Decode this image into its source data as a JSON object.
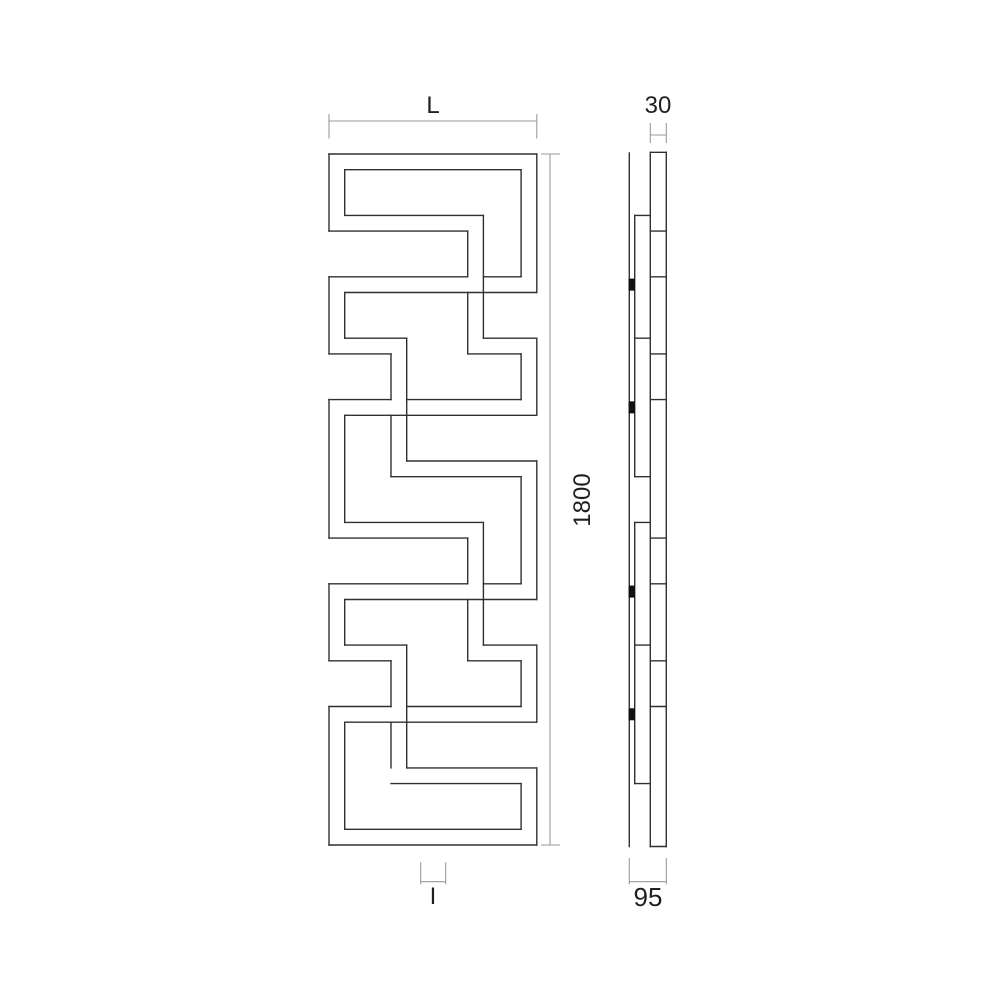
{
  "figure": {
    "background": "#ffffff",
    "line_color": "#303030",
    "dim_line_color": "#9a9a9a",
    "label_color": "#1f1f1f"
  },
  "labels": {
    "width": "L",
    "tube_depth": "30",
    "height": "1800",
    "total_depth": "95",
    "interaxis": "I"
  },
  "front_view": {
    "lines": [
      [
        329,
        154,
        536.8,
        154
      ],
      [
        344.7,
        169.7,
        521.1,
        169.7
      ],
      [
        344.7,
        215.4,
        483.4,
        215.4
      ],
      [
        329,
        231.1,
        467.7,
        231.1
      ],
      [
        329,
        276.8,
        467.7,
        276.8
      ],
      [
        483.4,
        276.8,
        521.1,
        276.8
      ],
      [
        344.7,
        292.5,
        536.8,
        292.5
      ],
      [
        344.7,
        338.2,
        406.7,
        338.2
      ],
      [
        329,
        353.9,
        391,
        353.9
      ],
      [
        483.4,
        338.2,
        536.8,
        338.2
      ],
      [
        467.7,
        353.9,
        521.1,
        353.9
      ],
      [
        329,
        399.6,
        391,
        399.6
      ],
      [
        406.7,
        399.6,
        521.1,
        399.6
      ],
      [
        344.7,
        415.3,
        536.8,
        415.3
      ],
      [
        406.7,
        461,
        536.8,
        461
      ],
      [
        391,
        476.7,
        521.1,
        476.7
      ],
      [
        344.7,
        522.4,
        483.4,
        522.4
      ],
      [
        329,
        538.1,
        467.7,
        538.1
      ],
      [
        329,
        583.8,
        467.7,
        583.8
      ],
      [
        483.4,
        583.8,
        521.1,
        583.8
      ],
      [
        344.7,
        599.5,
        536.8,
        599.5
      ],
      [
        344.7,
        645.1,
        406.7,
        645.1
      ],
      [
        329,
        660.8,
        391,
        660.8
      ],
      [
        483.4,
        645.1,
        536.8,
        645.1
      ],
      [
        467.7,
        660.8,
        521.1,
        660.8
      ],
      [
        329,
        706.5,
        391,
        706.5
      ],
      [
        406.7,
        706.5,
        521.1,
        706.5
      ],
      [
        344.7,
        722.2,
        536.8,
        722.2
      ],
      [
        406.7,
        767.9,
        536.8,
        767.9
      ],
      [
        391,
        783.6,
        521.1,
        783.6
      ],
      [
        344.7,
        829.3,
        521.1,
        829.3
      ],
      [
        329,
        845,
        536.8,
        845
      ],
      [
        329,
        154,
        329,
        231.1
      ],
      [
        344.7,
        169.7,
        344.7,
        215.4
      ],
      [
        329,
        276.8,
        329,
        353.9
      ],
      [
        344.7,
        292.5,
        344.7,
        338.2
      ],
      [
        329,
        399.6,
        329,
        538.1
      ],
      [
        344.7,
        415.3,
        344.7,
        522.4
      ],
      [
        329,
        583.8,
        329,
        660.8
      ],
      [
        344.7,
        599.5,
        344.7,
        645.1
      ],
      [
        329,
        706.5,
        329,
        845
      ],
      [
        344.7,
        722.2,
        344.7,
        829.3
      ],
      [
        536.8,
        154,
        536.8,
        292.5
      ],
      [
        521.1,
        169.7,
        521.1,
        276.8
      ],
      [
        536.8,
        338.2,
        536.8,
        415.3
      ],
      [
        521.1,
        353.9,
        521.1,
        399.6
      ],
      [
        536.8,
        461,
        536.8,
        599.5
      ],
      [
        521.1,
        476.7,
        521.1,
        583.8
      ],
      [
        536.8,
        645.1,
        536.8,
        722.2
      ],
      [
        521.1,
        660.8,
        521.1,
        706.5
      ],
      [
        536.8,
        767.9,
        536.8,
        845
      ],
      [
        521.1,
        783.6,
        521.1,
        829.3
      ],
      [
        467.7,
        231.1,
        467.7,
        276.8
      ],
      [
        467.7,
        292.5,
        467.7,
        353.9
      ],
      [
        483.4,
        215.4,
        483.4,
        338.2
      ],
      [
        467.7,
        538.1,
        467.7,
        583.8
      ],
      [
        467.7,
        599.5,
        467.7,
        660.8
      ],
      [
        483.4,
        522.4,
        483.4,
        645.1
      ],
      [
        391,
        353.9,
        391,
        399.6
      ],
      [
        391,
        415.3,
        391,
        476.7
      ],
      [
        406.7,
        338.2,
        406.7,
        461
      ],
      [
        391,
        660.8,
        391,
        706.5
      ],
      [
        391,
        722.2,
        391,
        767.9
      ],
      [
        406.7,
        645.1,
        406.7,
        767.9
      ]
    ]
  },
  "side_view": {
    "lines": [
      [
        629.3,
        153,
        629.3,
        846.5
      ],
      [
        650.3,
        152.3,
        650.3,
        846.5
      ],
      [
        666.3,
        152.3,
        666.3,
        846.5
      ],
      [
        650.3,
        152.3,
        666.3,
        152.3
      ],
      [
        650.3,
        846.5,
        666.3,
        846.5
      ],
      [
        650.3,
        231.1,
        666.3,
        231.1
      ],
      [
        650.3,
        276.8,
        666.3,
        276.8
      ],
      [
        650.3,
        353.9,
        666.3,
        353.9
      ],
      [
        650.3,
        399.6,
        666.3,
        399.6
      ],
      [
        650.3,
        538.1,
        666.3,
        538.1
      ],
      [
        650.3,
        583.8,
        666.3,
        583.8
      ],
      [
        650.3,
        660.8,
        666.3,
        660.8
      ],
      [
        650.3,
        706.5,
        666.3,
        706.5
      ],
      [
        634.7,
        215.4,
        634.7,
        476.7
      ],
      [
        634.7,
        215.4,
        650.3,
        215.4
      ],
      [
        634.7,
        338.2,
        650.3,
        338.2
      ],
      [
        634.7,
        476.7,
        650.3,
        476.7
      ],
      [
        634.7,
        522.4,
        634.7,
        783.6
      ],
      [
        634.7,
        522.4,
        650.3,
        522.4
      ],
      [
        634.7,
        645.1,
        650.3,
        645.1
      ],
      [
        634.7,
        783.6,
        650.3,
        783.6
      ]
    ],
    "clips": [
      [
        628.6,
        278.6,
        6.4,
        12
      ],
      [
        628.6,
        401.4,
        6.4,
        12
      ],
      [
        628.6,
        585.6,
        6.4,
        12
      ],
      [
        628.6,
        708.3,
        6.4,
        12
      ]
    ]
  },
  "dimensions": {
    "lines": [
      [
        329,
        121,
        536.8,
        121
      ],
      [
        329,
        114,
        329,
        138.5
      ],
      [
        536.8,
        114,
        536.8,
        138.5
      ],
      [
        550,
        154,
        550,
        845
      ],
      [
        541,
        154,
        560,
        154
      ],
      [
        541,
        845,
        560,
        845
      ],
      [
        650.3,
        135,
        666.3,
        135
      ],
      [
        650.3,
        123,
        650.3,
        143
      ],
      [
        666.3,
        123,
        666.3,
        143
      ],
      [
        629.3,
        881.7,
        666.3,
        881.7
      ],
      [
        629.3,
        858,
        629.3,
        884.3
      ],
      [
        666.3,
        858,
        666.3,
        884.3
      ],
      [
        420.7,
        881.7,
        445.7,
        881.7
      ],
      [
        420.7,
        862.3,
        420.7,
        884.3
      ],
      [
        445.7,
        862.3,
        445.7,
        884.3
      ]
    ]
  }
}
